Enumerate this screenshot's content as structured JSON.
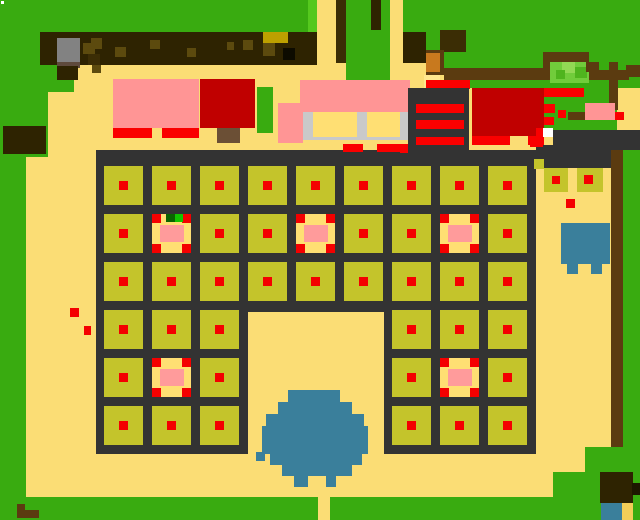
{
  "meta": {
    "width": 640,
    "height": 520,
    "scene": "pixel-farm-map"
  },
  "palette": {
    "ground": "#FBDD75",
    "green": "#39AB10",
    "greenBright": "#55C81E",
    "bush": "#71CC3B",
    "bushLight": "#92D854",
    "bushMid": "#4FB41E",
    "bandDark": "#2E2301",
    "bandSpot": "#5C4A0E",
    "bandYellow": "#BDA000",
    "saddle": "#5B3B10",
    "trunkDark": "#3B2D05",
    "orange": "#C8791E",
    "rock": "#828282",
    "rockShadow": "#5E4A3C",
    "fence": "#333333",
    "olive": "#C4C42B",
    "dot": "#F40000",
    "red": "#FA0000",
    "darkred": "#C00000",
    "pink": "#FF9595",
    "pinkPale": "#FF9B9B",
    "specialBg": "#FFDF73",
    "silver": "#C9C9C9",
    "blue": "#3A7F9B",
    "white": "#FFFFFF",
    "trunk": "#6B4F35",
    "sproutDark": "#0A6400",
    "sproutBright": "#12C400",
    "yellowPx": "#F2CE58",
    "ltYellow": "#FFE78F",
    "ink": "#0D0B00",
    "darkest": "#1D1700"
  },
  "shapes": [
    {
      "n": "grass-top-left",
      "x": 0,
      "y": 0,
      "w": 317,
      "h": 32,
      "c": "green"
    },
    {
      "n": "grass-left-upper",
      "x": 0,
      "y": 0,
      "w": 74,
      "h": 92,
      "c": "green"
    },
    {
      "n": "grass-left-top-ext",
      "x": 74,
      "y": 0,
      "w": 14,
      "h": 43,
      "c": "green"
    },
    {
      "n": "grass-left-mid",
      "x": 0,
      "y": 92,
      "w": 48,
      "h": 65,
      "c": "green"
    },
    {
      "n": "grass-left-column",
      "x": 0,
      "y": 157,
      "w": 26,
      "h": 363,
      "c": "green"
    },
    {
      "n": "grass-bright-px-1",
      "x": 75,
      "y": 32,
      "w": 13,
      "h": 11,
      "c": "greenBright"
    },
    {
      "n": "grass-bright-px-2",
      "x": 73,
      "y": 43,
      "w": 10,
      "h": 10,
      "c": "greenBright"
    },
    {
      "n": "grass-bright-strip",
      "x": 308,
      "y": 0,
      "w": 9,
      "h": 32,
      "c": "greenBright"
    },
    {
      "n": "grass-center-top",
      "x": 346,
      "y": 0,
      "w": 44,
      "h": 97,
      "c": "green"
    },
    {
      "n": "grass-top-right",
      "x": 403,
      "y": 0,
      "w": 237,
      "h": 52,
      "c": "green"
    },
    {
      "n": "grass-top-right-lower",
      "x": 444,
      "y": 52,
      "w": 196,
      "h": 36,
      "c": "green"
    },
    {
      "n": "grass-right-stripes-area",
      "x": 544,
      "y": 88,
      "w": 73,
      "h": 42,
      "c": "green"
    },
    {
      "n": "grass-right-column",
      "x": 623,
      "y": 150,
      "w": 17,
      "h": 347,
      "c": "green"
    },
    {
      "n": "grass-bottom-right-step1",
      "x": 585,
      "y": 447,
      "w": 55,
      "h": 50,
      "c": "green"
    },
    {
      "n": "grass-bottom-right-step2",
      "x": 553,
      "y": 472,
      "w": 58,
      "h": 25,
      "c": "green"
    },
    {
      "n": "grass-bottom-strip",
      "x": 0,
      "y": 497,
      "w": 640,
      "h": 23,
      "c": "green"
    },
    {
      "n": "path-gap-bottom",
      "x": 318,
      "y": 497,
      "w": 12,
      "h": 23,
      "c": "ground"
    },
    {
      "n": "tree-band",
      "x": 40,
      "y": 32,
      "w": 277,
      "h": 33,
      "c": "bandDark"
    },
    {
      "n": "tree-band-spot-1",
      "x": 91,
      "y": 38,
      "w": 11,
      "h": 11,
      "c": "bandSpot"
    },
    {
      "n": "tree-band-spot-2",
      "x": 115,
      "y": 47,
      "w": 11,
      "h": 10,
      "c": "bandSpot"
    },
    {
      "n": "tree-band-spot-3",
      "x": 150,
      "y": 40,
      "w": 10,
      "h": 9,
      "c": "bandSpot"
    },
    {
      "n": "tree-band-spot-4",
      "x": 187,
      "y": 48,
      "w": 9,
      "h": 9,
      "c": "bandSpot"
    },
    {
      "n": "tree-band-spot-5",
      "x": 227,
      "y": 42,
      "w": 7,
      "h": 8,
      "c": "bandSpot"
    },
    {
      "n": "tree-band-spot-6",
      "x": 243,
      "y": 40,
      "w": 10,
      "h": 10,
      "c": "bandSpot"
    },
    {
      "n": "band-yellow-block",
      "x": 263,
      "y": 32,
      "w": 25,
      "h": 11,
      "c": "bandYellow"
    },
    {
      "n": "band-yellow-px",
      "x": 263,
      "y": 43,
      "w": 12,
      "h": 13,
      "c": "bandSpot"
    },
    {
      "n": "band-black-px",
      "x": 283,
      "y": 48,
      "w": 12,
      "h": 12,
      "c": "ink"
    },
    {
      "n": "rock",
      "x": 57,
      "y": 38,
      "w": 23,
      "h": 26,
      "c": "rock"
    },
    {
      "n": "rock-shadow",
      "x": 57,
      "y": 62,
      "w": 23,
      "h": 6,
      "c": "rockShadow"
    },
    {
      "n": "rock-base",
      "x": 57,
      "y": 66,
      "w": 21,
      "h": 14,
      "c": "bandDark"
    },
    {
      "n": "trunk-px-1",
      "x": 83,
      "y": 43,
      "w": 12,
      "h": 11,
      "c": "bandSpot"
    },
    {
      "n": "trunk-px-2",
      "x": 88,
      "y": 54,
      "w": 12,
      "h": 11,
      "c": "trunkDark"
    },
    {
      "n": "trunk-px-3",
      "x": 92,
      "y": 65,
      "w": 9,
      "h": 8,
      "c": "bandSpot"
    },
    {
      "n": "path-top-a",
      "x": 317,
      "y": 0,
      "w": 23,
      "h": 65,
      "c": "ground"
    },
    {
      "n": "tree-trunk-col",
      "x": 336,
      "y": 0,
      "w": 10,
      "h": 63,
      "c": "trunkDark"
    },
    {
      "n": "tree-px-top",
      "x": 371,
      "y": 0,
      "w": 10,
      "h": 30,
      "c": "bandDark"
    },
    {
      "n": "path-top-b",
      "x": 390,
      "y": 0,
      "w": 13,
      "h": 97,
      "c": "ground"
    },
    {
      "n": "band-right-piece",
      "x": 403,
      "y": 32,
      "w": 23,
      "h": 31,
      "c": "bandDark"
    },
    {
      "n": "terrace-blob",
      "x": 440,
      "y": 30,
      "w": 26,
      "h": 22,
      "c": "trunkDark"
    },
    {
      "n": "terrace-left-block",
      "x": 426,
      "y": 50,
      "w": 18,
      "h": 25,
      "c": "saddle"
    },
    {
      "n": "terrace-orange",
      "x": 426,
      "y": 53,
      "w": 14,
      "h": 19,
      "c": "orange"
    },
    {
      "n": "terrace-h1",
      "x": 444,
      "y": 68,
      "w": 100,
      "h": 12,
      "c": "saddle"
    },
    {
      "n": "terrace-step-right",
      "x": 543,
      "y": 52,
      "w": 10,
      "h": 28,
      "c": "saddle"
    },
    {
      "n": "terrace-bush-top",
      "x": 551,
      "y": 52,
      "w": 38,
      "h": 10,
      "c": "saddle"
    },
    {
      "n": "bush",
      "x": 550,
      "y": 62,
      "w": 39,
      "h": 21,
      "c": "bush"
    },
    {
      "n": "bush-px-1",
      "x": 562,
      "y": 62,
      "w": 13,
      "h": 11,
      "c": "bushLight"
    },
    {
      "n": "bush-px-2",
      "x": 575,
      "y": 67,
      "w": 12,
      "h": 11,
      "c": "bushMid"
    },
    {
      "n": "bush-px-3",
      "x": 556,
      "y": 70,
      "w": 9,
      "h": 9,
      "c": "bushMid"
    },
    {
      "n": "terrace-step-2",
      "x": 586,
      "y": 62,
      "w": 13,
      "h": 10,
      "c": "saddle"
    },
    {
      "n": "terrace-h2",
      "x": 589,
      "y": 70,
      "w": 40,
      "h": 10,
      "c": "saddle"
    },
    {
      "n": "terrace-right-px",
      "x": 626,
      "y": 65,
      "w": 14,
      "h": 12,
      "c": "saddle"
    },
    {
      "n": "terrace-vert-right",
      "x": 609,
      "y": 62,
      "w": 9,
      "h": 48,
      "c": "saddle"
    },
    {
      "n": "field-fence-top-block",
      "x": 96,
      "y": 150,
      "w": 440,
      "h": 162,
      "c": "fence"
    },
    {
      "n": "field-fence-left-leg",
      "x": 96,
      "y": 300,
      "w": 152,
      "h": 154,
      "c": "fence"
    },
    {
      "n": "field-fence-right-leg",
      "x": 384,
      "y": 300,
      "w": 152,
      "h": 154,
      "c": "fence"
    },
    {
      "n": "fence-extension-right",
      "x": 536,
      "y": 145,
      "w": 75,
      "h": 23,
      "c": "fence"
    },
    {
      "n": "fence-band-top-right",
      "x": 553,
      "y": 130,
      "w": 87,
      "h": 20,
      "c": "fence"
    },
    {
      "n": "dirt-line-right",
      "x": 611,
      "y": 150,
      "w": 12,
      "h": 297,
      "c": "saddle"
    },
    {
      "n": "house-pink-left",
      "x": 113,
      "y": 79,
      "w": 86,
      "h": 49,
      "c": "pink",
      "i": true
    },
    {
      "n": "house-left-door-1",
      "x": 113,
      "y": 128,
      "w": 39,
      "h": 10,
      "c": "red"
    },
    {
      "n": "house-left-door-2",
      "x": 162,
      "y": 128,
      "w": 37,
      "h": 10,
      "c": "red"
    },
    {
      "n": "house-darkred-block",
      "x": 200,
      "y": 79,
      "w": 55,
      "h": 49,
      "c": "darkred",
      "i": true
    },
    {
      "n": "tree-trunk-center",
      "x": 217,
      "y": 128,
      "w": 23,
      "h": 15,
      "c": "trunk"
    },
    {
      "n": "tree-center",
      "x": 257,
      "y": 87,
      "w": 16,
      "h": 46,
      "c": "green"
    },
    {
      "n": "house-pink-main",
      "x": 300,
      "y": 80,
      "w": 110,
      "h": 32,
      "c": "pink",
      "i": true
    },
    {
      "n": "house-pink-wing",
      "x": 278,
      "y": 103,
      "w": 25,
      "h": 40,
      "c": "pink"
    },
    {
      "n": "house-frame-silver",
      "x": 303,
      "y": 112,
      "w": 105,
      "h": 28,
      "c": "silver"
    },
    {
      "n": "house-window-1",
      "x": 313,
      "y": 112,
      "w": 44,
      "h": 25,
      "c": "specialBg"
    },
    {
      "n": "house-window-2",
      "x": 367,
      "y": 112,
      "w": 33,
      "h": 25,
      "c": "specialBg"
    },
    {
      "n": "house-main-door-1",
      "x": 343,
      "y": 144,
      "w": 20,
      "h": 8,
      "c": "red"
    },
    {
      "n": "house-main-door-2",
      "x": 377,
      "y": 144,
      "w": 31,
      "h": 8,
      "c": "red"
    },
    {
      "n": "yellow-block",
      "x": 424,
      "y": 75,
      "w": 16,
      "h": 13,
      "c": "ltYellow"
    },
    {
      "n": "barn-roof-strip",
      "x": 426,
      "y": 80,
      "w": 44,
      "h": 9,
      "c": "red"
    },
    {
      "n": "barn-dark-building",
      "x": 408,
      "y": 88,
      "w": 61,
      "h": 72,
      "c": "fence",
      "i": true
    },
    {
      "n": "barn-stripe-1",
      "x": 416,
      "y": 104,
      "w": 48,
      "h": 9,
      "c": "red"
    },
    {
      "n": "barn-stripe-2",
      "x": 416,
      "y": 120,
      "w": 48,
      "h": 9,
      "c": "red"
    },
    {
      "n": "barn-stripe-3",
      "x": 416,
      "y": 137,
      "w": 48,
      "h": 8,
      "c": "red"
    },
    {
      "n": "barn-roof",
      "x": 472,
      "y": 88,
      "w": 72,
      "h": 48,
      "c": "darkred",
      "i": true
    },
    {
      "n": "barn-base-strip-1",
      "x": 472,
      "y": 136,
      "w": 38,
      "h": 9,
      "c": "red"
    },
    {
      "n": "barn-base-strip-2",
      "x": 528,
      "y": 136,
      "w": 16,
      "h": 9,
      "c": "red"
    },
    {
      "n": "fence-red-stripe-1",
      "x": 544,
      "y": 88,
      "w": 40,
      "h": 9,
      "c": "red"
    },
    {
      "n": "fence-red-stripe-2",
      "x": 544,
      "y": 104,
      "w": 11,
      "h": 9,
      "c": "red"
    },
    {
      "n": "fence-red-px-1",
      "x": 558,
      "y": 110,
      "w": 8,
      "h": 8,
      "c": "red"
    },
    {
      "n": "fence-red-stripe-3",
      "x": 544,
      "y": 117,
      "w": 10,
      "h": 8,
      "c": "red"
    },
    {
      "n": "pig",
      "x": 585,
      "y": 103,
      "w": 30,
      "h": 17,
      "c": "pink",
      "i": true
    },
    {
      "n": "pig-red-px",
      "x": 615,
      "y": 112,
      "w": 9,
      "h": 8,
      "c": "red"
    },
    {
      "n": "dirt-px",
      "x": 568,
      "y": 112,
      "w": 17,
      "h": 8,
      "c": "saddle"
    },
    {
      "n": "white-px",
      "x": 543,
      "y": 128,
      "w": 10,
      "h": 9,
      "c": "white"
    },
    {
      "n": "red-px-a",
      "x": 536,
      "y": 128,
      "w": 7,
      "h": 9,
      "c": "red"
    },
    {
      "n": "red-px-b",
      "x": 530,
      "y": 138,
      "w": 13,
      "h": 9,
      "c": "red"
    },
    {
      "n": "red-px-c",
      "x": 400,
      "y": 145,
      "w": 8,
      "h": 8,
      "c": "red"
    },
    {
      "n": "olive-px-corner",
      "x": 534,
      "y": 159,
      "w": 10,
      "h": 10,
      "c": "olive"
    },
    {
      "n": "side-plot-1",
      "x": 544,
      "y": 168,
      "w": 24,
      "h": 24,
      "c": "olive",
      "i": true
    },
    {
      "n": "side-plot-1-dot",
      "x": 552,
      "y": 176,
      "w": 8,
      "h": 8,
      "c": "dot"
    },
    {
      "n": "side-plot-2",
      "x": 577,
      "y": 168,
      "w": 26,
      "h": 24,
      "c": "olive",
      "i": true
    },
    {
      "n": "side-plot-2-dot",
      "x": 584,
      "y": 175,
      "w": 9,
      "h": 9,
      "c": "dot"
    },
    {
      "n": "red-dot-right",
      "x": 566,
      "y": 199,
      "w": 9,
      "h": 9,
      "c": "dot"
    },
    {
      "n": "pond-row-1",
      "x": 288,
      "y": 390,
      "w": 52,
      "h": 14,
      "c": "blue"
    },
    {
      "n": "pond-row-2",
      "x": 278,
      "y": 402,
      "w": 74,
      "h": 14,
      "c": "blue"
    },
    {
      "n": "pond-row-3",
      "x": 266,
      "y": 414,
      "w": 98,
      "h": 14,
      "c": "blue"
    },
    {
      "n": "pond-row-4",
      "x": 262,
      "y": 426,
      "w": 106,
      "h": 28,
      "c": "blue"
    },
    {
      "n": "pond-row-5",
      "x": 270,
      "y": 452,
      "w": 92,
      "h": 13,
      "c": "blue"
    },
    {
      "n": "pond-row-6",
      "x": 282,
      "y": 464,
      "w": 70,
      "h": 12,
      "c": "blue"
    },
    {
      "n": "pond-leg-1",
      "x": 294,
      "y": 476,
      "w": 14,
      "h": 11,
      "c": "blue"
    },
    {
      "n": "pond-leg-2",
      "x": 326,
      "y": 476,
      "w": 10,
      "h": 11,
      "c": "blue"
    },
    {
      "n": "pond-stray-px",
      "x": 256,
      "y": 452,
      "w": 9,
      "h": 9,
      "c": "blue"
    },
    {
      "n": "red-dot-left-1",
      "x": 70,
      "y": 308,
      "w": 9,
      "h": 9,
      "c": "dot"
    },
    {
      "n": "red-dot-left-2",
      "x": 84,
      "y": 326,
      "w": 7,
      "h": 9,
      "c": "dot"
    },
    {
      "n": "dark-square-left",
      "x": 3,
      "y": 126,
      "w": 43,
      "h": 28,
      "c": "bandDark"
    },
    {
      "n": "brown-l-1",
      "x": 17,
      "y": 504,
      "w": 8,
      "h": 7,
      "c": "saddle"
    },
    {
      "n": "brown-l-2",
      "x": 17,
      "y": 510,
      "w": 22,
      "h": 8,
      "c": "saddle"
    },
    {
      "n": "white-dot-corner",
      "x": 1,
      "y": 1,
      "w": 3,
      "h": 3,
      "c": "white"
    },
    {
      "n": "br-brown-block",
      "x": 600,
      "y": 472,
      "w": 33,
      "h": 31,
      "c": "bandDark"
    },
    {
      "n": "br-dark-px",
      "x": 632,
      "y": 483,
      "w": 8,
      "h": 12,
      "c": "darkest"
    },
    {
      "n": "br-blue-px",
      "x": 601,
      "y": 503,
      "w": 21,
      "h": 17,
      "c": "blue"
    },
    {
      "n": "br-yellow-px",
      "x": 622,
      "y": 503,
      "w": 11,
      "h": 17,
      "c": "yellowPx"
    }
  ],
  "field": {
    "x": 104,
    "y": 166,
    "pitch": 48,
    "tile": 39,
    "cols": 9,
    "rows": 6,
    "cutout_rows": [
      3,
      4,
      5
    ],
    "cutout_cols": [
      3,
      4,
      5
    ],
    "special_plots": [
      [
        1,
        1
      ],
      [
        1,
        4
      ],
      [
        1,
        7
      ],
      [
        4,
        1
      ],
      [
        4,
        7
      ]
    ],
    "sprout_plot": [
      1,
      1
    ],
    "plot_color": "olive",
    "dot_color": "dot",
    "dot_size": 9,
    "dot_offset": 15,
    "special": {
      "bg": "specialBg",
      "corner_color": "dot",
      "corner_size": 9,
      "pink": {
        "x": 8,
        "y": 11,
        "w": 24,
        "h": 17,
        "color": "pinkPale"
      },
      "sprout_dark": {
        "x": 14,
        "y": 0,
        "w": 9,
        "h": 8,
        "color": "sproutDark"
      },
      "sprout_bright": {
        "x": 23,
        "y": 0,
        "w": 8,
        "h": 8,
        "color": "sproutBright"
      }
    }
  },
  "creature": {
    "color": "blue",
    "body": {
      "x": 561,
      "y": 223,
      "w": 49,
      "h": 41
    },
    "legs": [
      {
        "x": 567,
        "y": 264,
        "w": 11,
        "h": 10
      },
      {
        "x": 591,
        "y": 264,
        "w": 11,
        "h": 10
      }
    ]
  }
}
